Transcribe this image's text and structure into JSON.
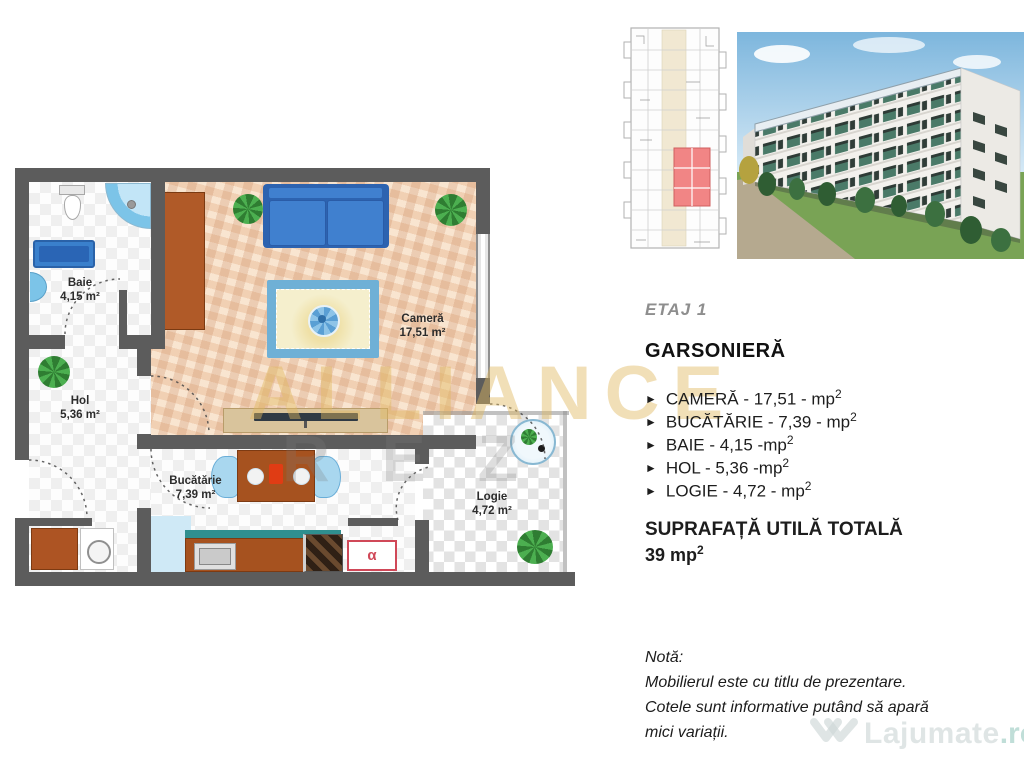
{
  "plan": {
    "rooms": {
      "baie": {
        "name": "Baie",
        "area": "4,15 m²"
      },
      "hol": {
        "name": "Hol",
        "area": "5,36 m²"
      },
      "camera": {
        "name": "Cameră",
        "area": "17,51 m²"
      },
      "bucatarie": {
        "name": "Bucătărie",
        "area": "7,39 m²"
      },
      "logie": {
        "name": "Logie",
        "area": "4,72 m²"
      }
    },
    "boiler_symbol": "α"
  },
  "panel": {
    "floor": "ETAJ 1",
    "type": "GARSONIERĂ",
    "bullet": "►",
    "items": [
      {
        "text": "CAMERĂ - 17,51 - mp",
        "sup": "2"
      },
      {
        "text": "BUCĂTĂRIE - 7,39 - mp",
        "sup": "2"
      },
      {
        "text": "BAIE - 4,15 -mp",
        "sup": "2"
      },
      {
        "text": "HOL - 5,36 -mp",
        "sup": "2"
      },
      {
        "text": "LOGIE - 4,72 - mp",
        "sup": "2"
      }
    ],
    "total_label": "SUPRAFAȚĂ UTILĂ TOTALĂ",
    "total_value": "39 mp",
    "total_sup": "2"
  },
  "note": {
    "title": "Notă:",
    "line1": "Mobilierul este cu titlu de prezentare.",
    "line2": "Cotele sunt informative putând să apară",
    "line3": "mici variații."
  },
  "watermarks": {
    "brand": "ALLIANCE",
    "brand_sub": "REZ",
    "site_name": "Lajumate",
    "site_tld": ".ro"
  },
  "colors": {
    "wall": "#5c5c5c",
    "camera_floor": "#f1d0b3",
    "accent_gold": "#e0b95f",
    "highlight_unit": "#ef8585",
    "sofa_blue": "#3f7ecc",
    "furniture_brown": "#a6521f",
    "counter_teal": "#2f8f8f"
  }
}
